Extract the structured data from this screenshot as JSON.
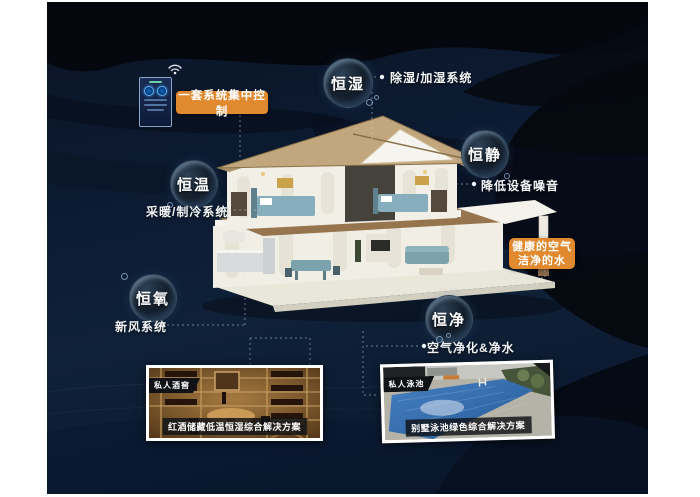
{
  "bubbles": {
    "humidity": "恒湿",
    "quiet": "恒静",
    "temperature": "恒温",
    "oxygen": "恒氧",
    "purity": "恒净"
  },
  "features": {
    "humidity": "除湿/加湿系统",
    "quiet": "降低设备噪音",
    "temperature": "采暖/制冷系统",
    "oxygen": "新风系统",
    "purity": "空气净化&净水"
  },
  "control": {
    "label": "一套系统集中控制"
  },
  "banner": {
    "line1": "健康的空气",
    "line2": "洁净的水"
  },
  "photos": {
    "wine": {
      "tag": "私人酒窖",
      "caption": "红酒储藏低温恒湿综合解决方案"
    },
    "pool": {
      "tag": "私人泳池",
      "caption": "别墅泳池绿色综合解决方案"
    }
  },
  "icons": {
    "wifi": "wifi-icon",
    "control_panel": "smart-control-panel"
  },
  "colors": {
    "accent_orange": "#e1892f",
    "background_navy": "#0c1a30",
    "bubble_rim": "#91bee8",
    "label_text": "#f2f5f8",
    "photo_tag_bg": "#101216"
  }
}
